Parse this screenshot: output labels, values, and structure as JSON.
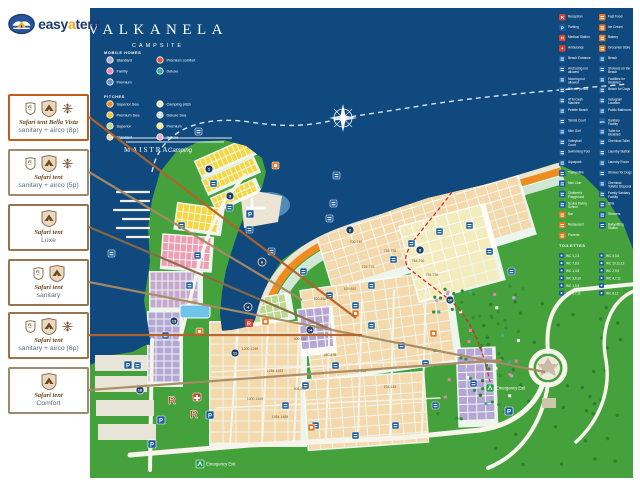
{
  "logo": {
    "text_easy": "easy",
    "text_a": "a",
    "text_tent": "tent"
  },
  "sidebar": {
    "boxes": [
      {
        "title": "Safari tent Bella Vista",
        "subtitle": "sanitary + airco (8p)",
        "border_color": "#bf5e1a",
        "line_color": "#b4622a"
      },
      {
        "title": "Safari tent",
        "subtitle": "sanitary + airco (5p)",
        "border_color": "#a08a6e",
        "line_color": "#a98a62"
      },
      {
        "title": "Safari tent",
        "subtitle": "Luxe",
        "border_color": "#97764f",
        "line_color": "#8a6a46"
      },
      {
        "title": "Safari tent",
        "subtitle": "sanitary",
        "border_color": "#97764f",
        "line_color": "#a98a62"
      },
      {
        "title": "Safari tent",
        "subtitle": "sanitary + airco (6p)",
        "border_color": "#97764f",
        "line_color": "#b4622a"
      },
      {
        "title": "Safari tent",
        "subtitle": "Comfort",
        "border_color": "#a08a6e",
        "line_color": "#a98a62"
      }
    ]
  },
  "map": {
    "title": "VALKANELA",
    "subtitle": "CAMPSITE",
    "brand": "MAISTRA",
    "brand_script": "Camping",
    "colors": {
      "sea": "#10497e",
      "land": "#44a13c",
      "road": "#f7f4ec"
    },
    "legend": {
      "mobile_homes_header": "MOBILE HOMES",
      "pitches_header": "PITCHES",
      "mobile_homes": [
        {
          "label": "Standard",
          "color": "#b5a6d6"
        },
        {
          "label": "Premium comfort",
          "color": "#e2543e"
        },
        {
          "label": "Family",
          "color": "#ef87ae"
        },
        {
          "label": "Deluxe",
          "color": "#2fae9b"
        },
        {
          "label": "Premium",
          "color": "#6b8fc2"
        }
      ],
      "pitches": [
        {
          "label": "Superior Sea",
          "color": "#f08c1e"
        },
        {
          "label": "Camping pitch",
          "color": "#f3ecbe"
        },
        {
          "label": "Premium Sea",
          "color": "#f7c32a"
        },
        {
          "label": "Deluxe Sea",
          "color": "#cfe3ea"
        },
        {
          "label": "Superior",
          "color": "#bcd98f"
        },
        {
          "label": "Premium",
          "color": "#f6e88e"
        },
        {
          "label": "Standard",
          "color": "#f4d9ad"
        },
        {
          "label": "Deluxe",
          "color": "#f0a8c4"
        }
      ]
    },
    "facilities_col1": [
      {
        "label": "Reception",
        "color": "#d6402e",
        "glyph": "R"
      },
      {
        "label": "Parking",
        "color": "#1b5c9e",
        "glyph": "P"
      },
      {
        "label": "Medical Station",
        "color": "#d6402e",
        "glyph": "H"
      },
      {
        "label": "Ambulance",
        "color": "#d6402e",
        "glyph": "+"
      },
      {
        "label": "Beach Entrance",
        "color": "#1b5c9e"
      },
      {
        "label": "Anchoring not allowed",
        "color": "#1b5c9e"
      },
      {
        "label": "Mooring not allowed",
        "color": "#1b5c9e"
      },
      {
        "label": "Silence period",
        "color": "#1b5c9e"
      },
      {
        "label": "ATM Cash Machine",
        "color": "#1b5c9e"
      },
      {
        "label": "Pebble Beach",
        "color": "#1b5c9e"
      },
      {
        "label": "Tennis Court",
        "color": "#1b5c9e"
      },
      {
        "label": "Mini Golf",
        "color": "#1b5c9e"
      },
      {
        "label": "Volleyball Court",
        "color": "#1b5c9e"
      },
      {
        "label": "Swimming Pool",
        "color": "#1b5c9e"
      },
      {
        "label": "Aquapark",
        "color": "#1b5c9e"
      },
      {
        "label": "Trampoline",
        "color": "#1b5c9e"
      },
      {
        "label": "Mini Club",
        "color": "#1b5c9e"
      },
      {
        "label": "Children's Playground",
        "color": "#1b5c9e"
      },
      {
        "label": "Scuba Diving School",
        "color": "#1b5c9e"
      },
      {
        "label": "Bar",
        "color": "#e87722"
      },
      {
        "label": "Restaurant",
        "color": "#e87722"
      },
      {
        "label": "Pizzeria",
        "color": "#e87722"
      }
    ],
    "facilities_col2": [
      {
        "label": "Fast Food",
        "color": "#e87722"
      },
      {
        "label": "Ice Cream",
        "color": "#e87722"
      },
      {
        "label": "Bakery",
        "color": "#e87722"
      },
      {
        "label": "Groceries Store",
        "color": "#e87722"
      },
      {
        "label": "Beach",
        "color": "#1b5c9e"
      },
      {
        "label": "Showers on the Beach",
        "color": "#1b5c9e"
      },
      {
        "label": "Facilities for Disabled",
        "color": "#1b5c9e"
      },
      {
        "label": "Beach for Dogs",
        "color": "#1b5c9e"
      },
      {
        "label": "Instagram Location",
        "color": "#1b5c9e"
      },
      {
        "label": "Public Bathroom",
        "color": "#1b5c9e"
      },
      {
        "label": "Sanitary Facility",
        "color": "#1b5c9e",
        "glyph": "WC"
      },
      {
        "label": "Toilet for Disabled",
        "color": "#1b5c9e"
      },
      {
        "label": "Chemical Toilet",
        "color": "#1b5c9e"
      },
      {
        "label": "Laundry Station",
        "color": "#1b5c9e"
      },
      {
        "label": "Laundry Room",
        "color": "#1b5c9e"
      },
      {
        "label": "Shower for Dogs",
        "color": "#1b5c9e"
      },
      {
        "label": "Chemical Toilette Disposal",
        "color": "#1b5c9e"
      },
      {
        "label": "Family Sanitary Facility",
        "color": "#1b5c9e"
      },
      {
        "label": "Sink",
        "color": "#1b5c9e"
      },
      {
        "label": "Showers",
        "color": "#1b5c9e"
      },
      {
        "label": "Babysitting Station",
        "color": "#1b5c9e"
      }
    ],
    "wc_section": {
      "header": "TOILETTES",
      "entries": [
        "WC 1,2,3",
        "WC 4,5,6",
        "WC 7,8,9",
        "WC 10,11,12",
        "WC 1,4,8",
        "WC 2,5,9",
        "WC 3,6,10",
        "WC 4,7,11",
        "WC 1,5,9",
        "WC 2,6,10",
        "WC 3,7,11",
        "WC 8,12"
      ]
    },
    "plot_labels": [
      "700-740",
      "735-758",
      "764-790",
      "716-719",
      "754-756",
      "629-652",
      "520-552",
      "904-906",
      "1200-1249",
      "1254-1283",
      "1400-1449",
      "1454-1489",
      "400-448",
      "450-498",
      "304-348",
      "104-148"
    ],
    "zone_markers": [
      "1",
      "2",
      "3",
      "4",
      "6",
      "8",
      "10",
      "11",
      "13",
      "14",
      "18"
    ],
    "markers": {
      "reception": "R",
      "parking": "P"
    },
    "emergency_exit": "Emergency Exit"
  }
}
